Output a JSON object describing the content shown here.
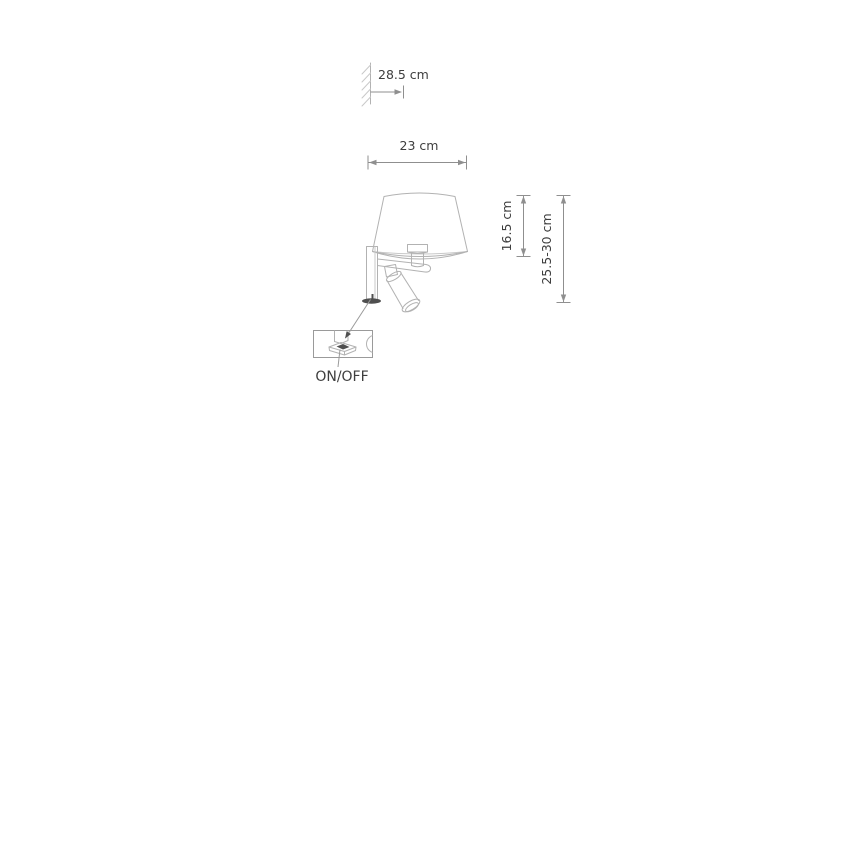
{
  "labels": {
    "wall_distance": "28.5 cm",
    "shade_width": "23 cm",
    "shade_height": "16.5 cm",
    "mount_height_range": "25.5-30 cm",
    "switch": "ON/OFF"
  },
  "colors": {
    "background": "#ffffff",
    "line": "#b2b2b2",
    "linesoft": "#c9c9c9",
    "dim": "#8f8f8f",
    "text": "#3e3e3e",
    "dark": "#4f4f4f"
  },
  "diagram": {
    "type": "wall-lamp dimension drawing",
    "parts": [
      "wall-surface-hatch",
      "lamp-shade",
      "lamp-socket",
      "wall-bracket-plate",
      "lamp-arm",
      "reading-spotlight",
      "switch-detail-callout"
    ]
  }
}
